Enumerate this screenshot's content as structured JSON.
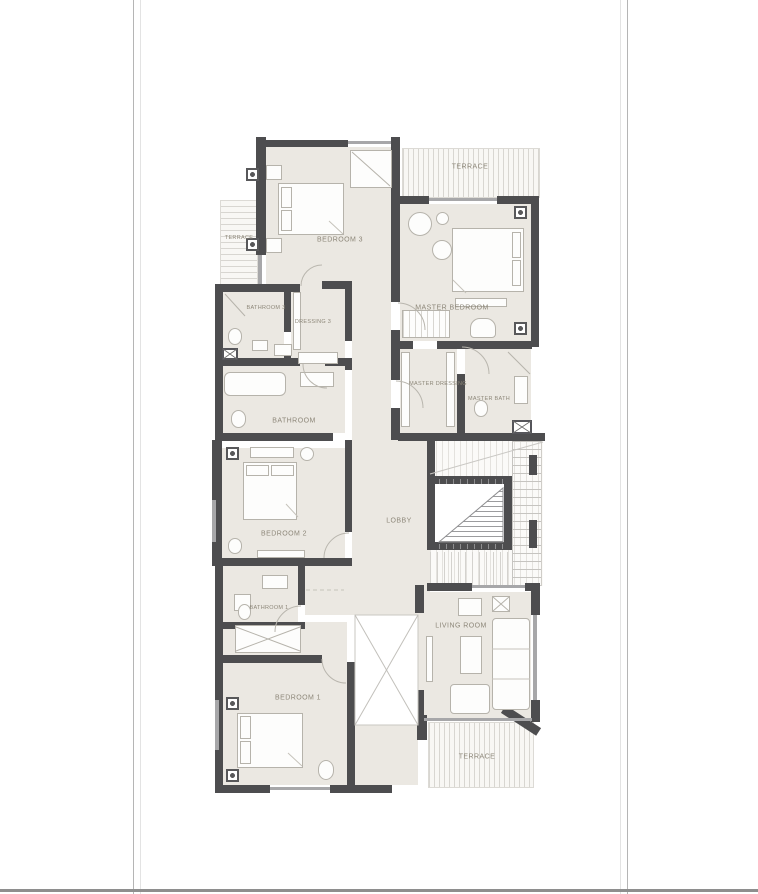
{
  "title": "apartment-floor-plan",
  "colors": {
    "wall": "#4d4d4f",
    "floor": "#ebe8e2",
    "furn": "#b6b3ab",
    "label": "#8d8779"
  },
  "rooms": {
    "bedroom3": "BEDROOM 3",
    "terrace_top": "TERRACE",
    "terrace_left": "TERRACE",
    "master_bedroom": "MASTER BEDROOM",
    "bathroom3": "BATHROOM 3",
    "dressing3": "DRESSING 3",
    "master_dressing": "MASTER DRESSING",
    "master_bath": "MASTER BATH",
    "bathroom": "BATHROOM",
    "bedroom2": "BEDROOM 2",
    "lobby": "LOBBY",
    "bathroom1": "BATHROOM 1",
    "bedroom1": "BEDROOM 1",
    "living_room": "LIVING ROOM",
    "terrace_bottom": "TERRACE"
  }
}
